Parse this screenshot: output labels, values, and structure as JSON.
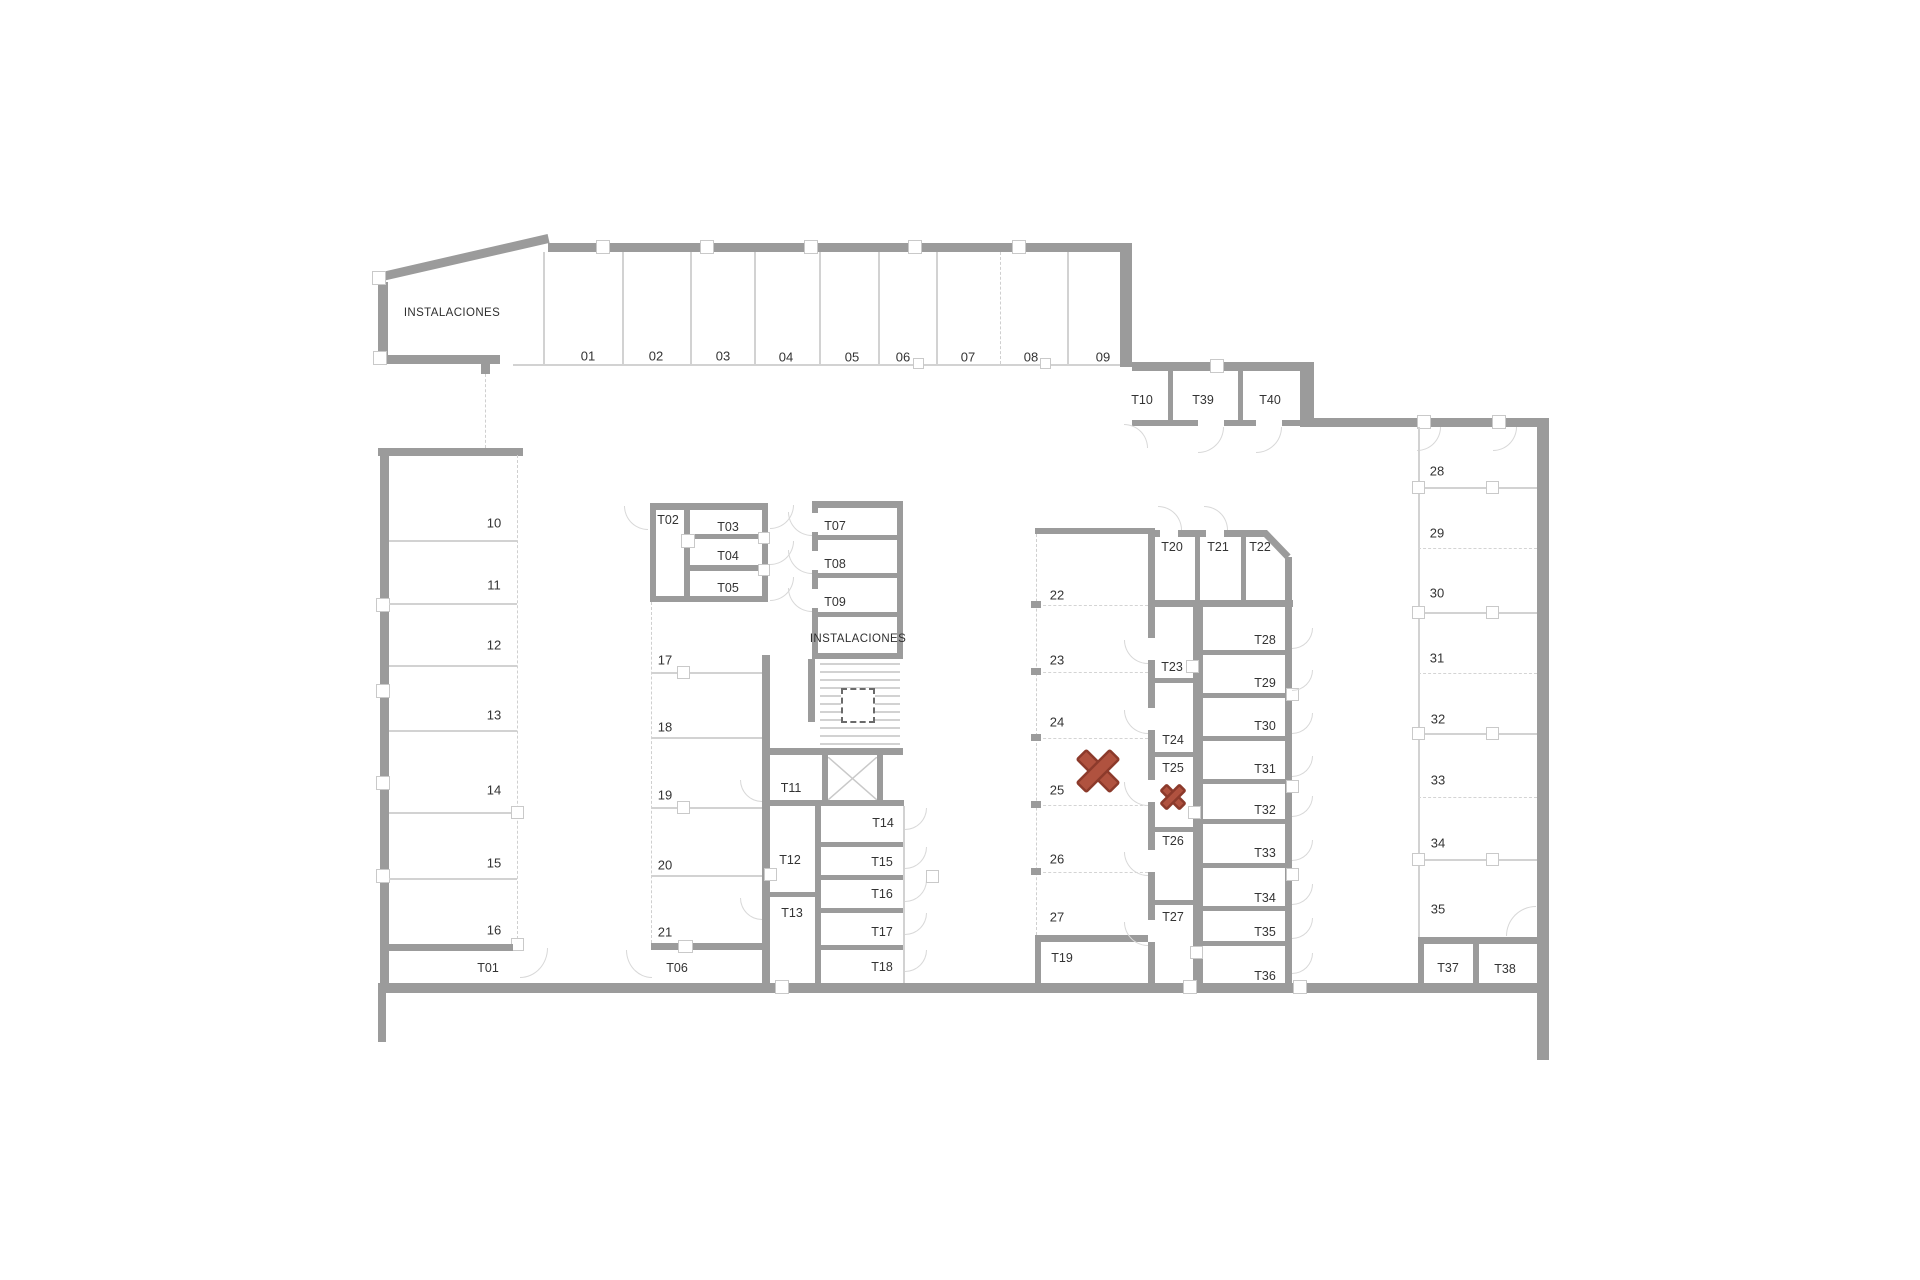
{
  "plan": {
    "instalaciones_upper": "INSTALACIONES",
    "instalaciones_middle": "INSTALACIONES",
    "parking": {
      "top": [
        "01",
        "02",
        "03",
        "04",
        "05",
        "06",
        "07",
        "08",
        "09"
      ],
      "left": [
        "10",
        "11",
        "12",
        "13",
        "14",
        "15",
        "16"
      ],
      "center": [
        "17",
        "18",
        "19",
        "20",
        "21"
      ],
      "middle": [
        "22",
        "23",
        "24",
        "25",
        "26",
        "27"
      ],
      "right": [
        "28",
        "29",
        "30",
        "31",
        "32",
        "33",
        "34",
        "35"
      ]
    },
    "storage": [
      "T01",
      "T02",
      "T03",
      "T04",
      "T05",
      "T06",
      "T07",
      "T08",
      "T09",
      "T10",
      "T11",
      "T12",
      "T13",
      "T14",
      "T15",
      "T16",
      "T17",
      "T18",
      "T19",
      "T20",
      "T21",
      "T22",
      "T23",
      "T24",
      "T25",
      "T26",
      "T27",
      "T28",
      "T29",
      "T30",
      "T31",
      "T32",
      "T33",
      "T34",
      "T35",
      "T36",
      "T37",
      "T38",
      "T39",
      "T40"
    ]
  },
  "colors": {
    "wall": "#9b9b9b",
    "thin_line": "#d2d2d2",
    "label_text": "#333333",
    "marker_fill": "#b0523f",
    "marker_stroke": "#8c3a2b"
  }
}
